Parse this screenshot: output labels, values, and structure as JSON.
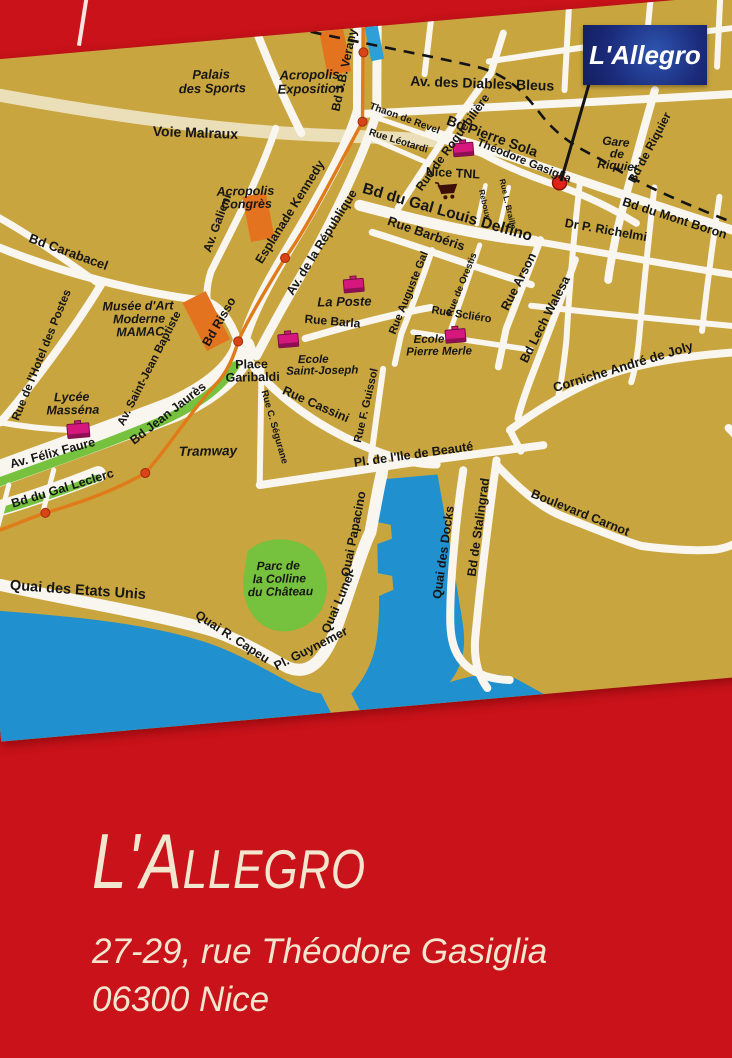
{
  "card": {
    "title": "L'Allegro",
    "address_line1": "27-29, rue Théodore Gasiglia",
    "address_line2": "06300 Nice"
  },
  "map": {
    "flag": {
      "label": "L'Allegro"
    },
    "colors": {
      "card_red": "#c9121a",
      "cream": "#f2e6cf",
      "land": "#c9a53f",
      "road": "#f9f6ef",
      "road_cream": "#eadfb8",
      "sea": "#2090cf",
      "park": "#76c13d",
      "building_orange": "#e4731f",
      "tram_orange": "#e07b1a",
      "tram_stop": "#d94416",
      "poi_pink": "#d6187e",
      "poi_dark": "#8e0f54",
      "railway": "#141414",
      "label_color": "#161616",
      "flag_blue": "#1b2a7a",
      "flag_glow": "#2e55b0",
      "flag_text": "#ffffff",
      "marker_red": "#e02318"
    },
    "labels": [
      {
        "id": "palais-des-sports",
        "lines": [
          "Palais",
          "des Sports"
        ]
      },
      {
        "id": "acropolis-exposition",
        "lines": [
          "Acropolis",
          "Exposition"
        ]
      },
      {
        "id": "voie-malraux",
        "lines": [
          "Voie Malraux"
        ]
      },
      {
        "id": "bd-jb-verany",
        "lines": [
          "Bd J.B. Verany"
        ]
      },
      {
        "id": "av-des-diables-bleus",
        "lines": [
          "Av. des Diables Bleus"
        ]
      },
      {
        "id": "thaon-de-revel",
        "lines": [
          "Thaon de Revel"
        ]
      },
      {
        "id": "rue-leotardi",
        "lines": [
          "Rue Léotardi"
        ]
      },
      {
        "id": "rue-de-roquebiliere",
        "lines": [
          "Rue de Roquebilière"
        ]
      },
      {
        "id": "bd-pierre-sola",
        "lines": [
          "Bd Pierre Sola"
        ]
      },
      {
        "id": "nice-tnl",
        "lines": [
          "Nice TNL"
        ]
      },
      {
        "id": "theodore-gasiglia",
        "lines": [
          "Théodore Gasiglia"
        ]
      },
      {
        "id": "reboux",
        "lines": [
          "Reboux"
        ]
      },
      {
        "id": "rue-l-braille",
        "lines": [
          "Rue L. Braille"
        ]
      },
      {
        "id": "gare-de-riquier",
        "lines": [
          "Gare",
          "de",
          "Riquier"
        ]
      },
      {
        "id": "bd-de-riquier",
        "lines": [
          "Bd de Riquier"
        ]
      },
      {
        "id": "esplanade-kennedy",
        "lines": [
          "Esplanade Kennedy"
        ]
      },
      {
        "id": "av-de-la-republique",
        "lines": [
          "Av. de la République"
        ]
      },
      {
        "id": "av-galieni",
        "lines": [
          "Av. Galieni"
        ]
      },
      {
        "id": "acropolis-congres",
        "lines": [
          "Acropolis",
          "Congrès"
        ]
      },
      {
        "id": "bd-carabacel",
        "lines": [
          "Bd Carabacel"
        ]
      },
      {
        "id": "rue-hotel-des-postes",
        "lines": [
          "Rue de l'Hotel des Postes"
        ]
      },
      {
        "id": "musee-mamac",
        "lines": [
          "Musée d'Art",
          "Moderne",
          "MAMAC"
        ]
      },
      {
        "id": "av-saint-jean-baptiste",
        "lines": [
          "Av. Saint-Jean Baptiste"
        ]
      },
      {
        "id": "bd-risso",
        "lines": [
          "Bd Risso"
        ]
      },
      {
        "id": "bd-gal-louis-delfino",
        "lines": [
          "Bd du Gal Louis Delfino"
        ]
      },
      {
        "id": "rue-barberis",
        "lines": [
          "Rue Barbéris"
        ]
      },
      {
        "id": "dr-p-richelmi",
        "lines": [
          "Dr P. Richelmi"
        ]
      },
      {
        "id": "bd-du-mont-boron",
        "lines": [
          "Bd du Mont Boron"
        ]
      },
      {
        "id": "la-poste",
        "lines": [
          "La Poste"
        ]
      },
      {
        "id": "rue-barla",
        "lines": [
          "Rue Barla"
        ]
      },
      {
        "id": "ecole-saint-joseph",
        "lines": [
          "Ecole",
          "Saint-Joseph"
        ]
      },
      {
        "id": "rue-auguste-gal",
        "lines": [
          "Rue Auguste Gal"
        ]
      },
      {
        "id": "rue-de-orestis",
        "lines": [
          "Rue de Orestis"
        ]
      },
      {
        "id": "rue-scliero",
        "lines": [
          "Rue Scliéro"
        ]
      },
      {
        "id": "ecole-pierre-merle",
        "lines": [
          "Ecole",
          "Pierre Merle"
        ]
      },
      {
        "id": "rue-arson",
        "lines": [
          "Rue Arson"
        ]
      },
      {
        "id": "bd-lech-walesa",
        "lines": [
          "Bd Lech Walesa"
        ]
      },
      {
        "id": "corniche-andre-de-joly",
        "lines": [
          "Corniche André de Joly"
        ]
      },
      {
        "id": "place-garibaldi",
        "lines": [
          "Place",
          "Garibaldi"
        ]
      },
      {
        "id": "rue-cassini",
        "lines": [
          "Rue Cassini"
        ]
      },
      {
        "id": "rue-c-segurane",
        "lines": [
          "Rue C. Ségurane"
        ]
      },
      {
        "id": "lycee-massena",
        "lines": [
          "Lycée",
          "Masséna"
        ]
      },
      {
        "id": "av-felix-faure",
        "lines": [
          "Av. Félix Faure"
        ]
      },
      {
        "id": "bd-jean-jaures",
        "lines": [
          "Bd Jean Jaurès"
        ]
      },
      {
        "id": "tramway",
        "lines": [
          "Tramway"
        ]
      },
      {
        "id": "bd-gal-leclerc",
        "lines": [
          "Bd du Gal Leclerc"
        ]
      },
      {
        "id": "quai-des-etats-unis",
        "lines": [
          "Quai des Etats Unis"
        ]
      },
      {
        "id": "parc-colline-chateau",
        "lines": [
          "Parc de",
          "la Colline",
          "du Château"
        ]
      },
      {
        "id": "quai-r-capeu",
        "lines": [
          "Quai R. Capeu"
        ]
      },
      {
        "id": "pl-guynemer",
        "lines": [
          "Pl. Guynemer"
        ]
      },
      {
        "id": "quai-lunel",
        "lines": [
          "Quai Lunel"
        ]
      },
      {
        "id": "quai-papacino",
        "lines": [
          "Quai Papacino"
        ]
      },
      {
        "id": "pl-ile-de-beaute",
        "lines": [
          "Pl. de l'Ile de Beauté"
        ]
      },
      {
        "id": "quai-des-docks",
        "lines": [
          "Quai des Docks"
        ]
      },
      {
        "id": "bd-de-stalingrad",
        "lines": [
          "Bd de Stalingrad"
        ]
      },
      {
        "id": "boulevard-carnot",
        "lines": [
          "Boulevard Carnot"
        ]
      },
      {
        "id": "rue-f-guissol",
        "lines": [
          "Rue F. Guissol"
        ]
      }
    ]
  }
}
